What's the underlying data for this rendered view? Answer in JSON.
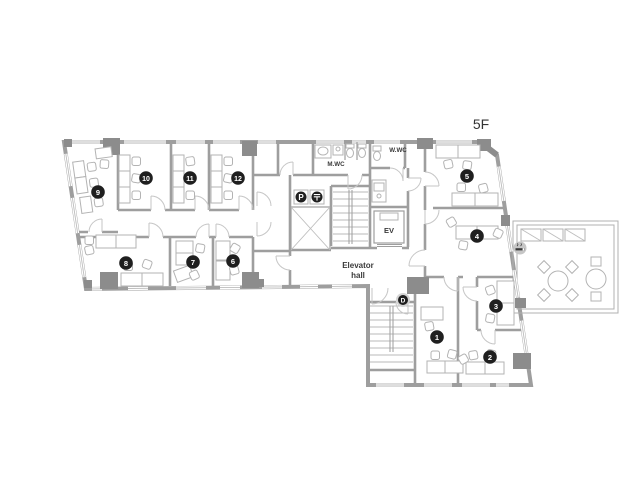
{
  "floor_label": "5F",
  "rooms": [
    {
      "number": "1"
    },
    {
      "number": "2"
    },
    {
      "number": "3"
    },
    {
      "number": "4"
    },
    {
      "number": "5"
    },
    {
      "number": "6"
    },
    {
      "number": "7"
    },
    {
      "number": "8"
    },
    {
      "number": "9"
    },
    {
      "number": "10"
    },
    {
      "number": "11"
    },
    {
      "number": "12"
    }
  ],
  "labels": {
    "mens_wc": "M.WC",
    "womens_wc": "W.WC",
    "elevator": "EV",
    "elevator_hall_line1": "Elevator",
    "elevator_hall_line2": "hall"
  },
  "markers": {
    "p_sign": "P",
    "post_sign": "〒",
    "d_sign": "D"
  },
  "icons": {
    "smoking": "smoking-area"
  },
  "colors": {
    "wall": "#9e9e9e",
    "column": "#8c8c8c",
    "badge": "#1f1f1f",
    "furniture_line": "#b3b3b3",
    "background": "#ffffff"
  }
}
